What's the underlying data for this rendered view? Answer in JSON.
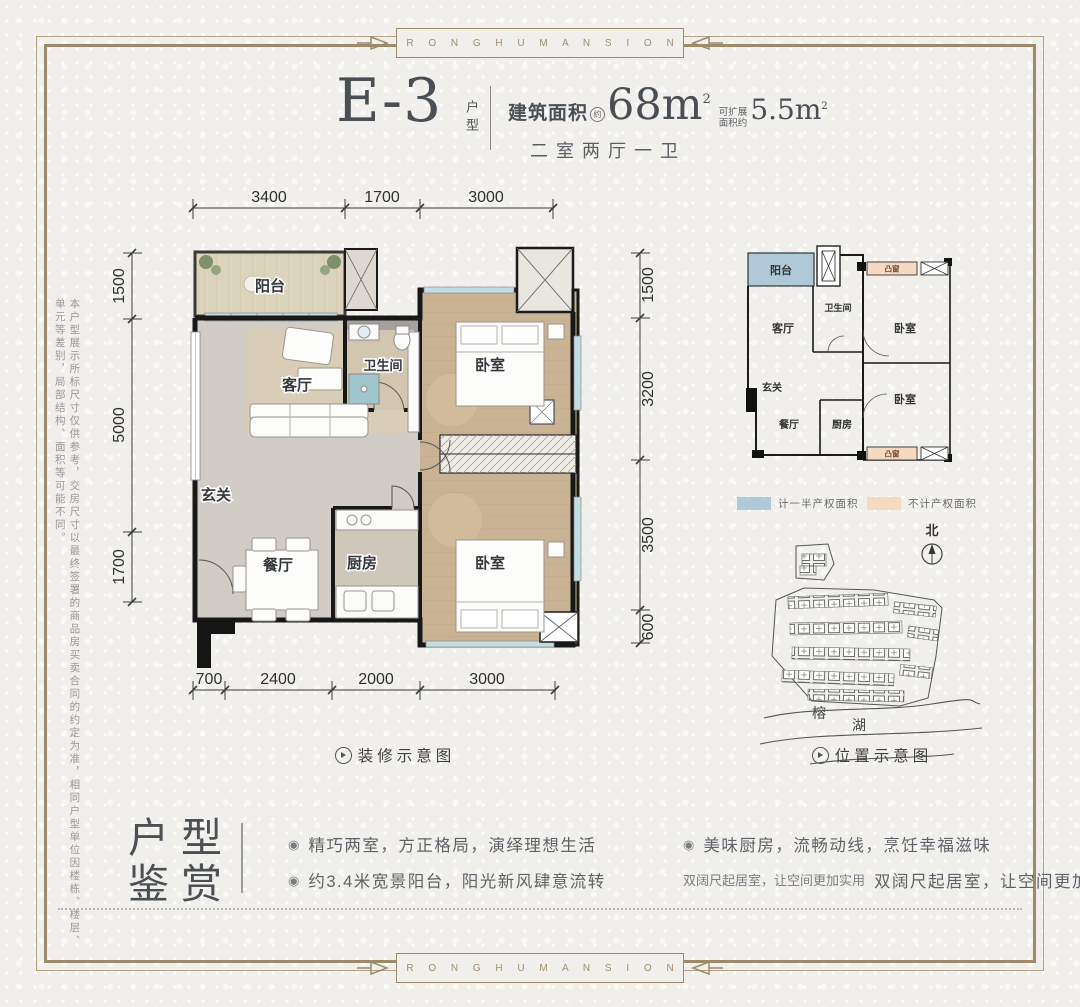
{
  "border": {
    "brand_text": "R O N G H U M A N S I O N"
  },
  "header": {
    "unit_code": "E-3",
    "unit_type_vertical": "户型",
    "area_label": "建筑面积",
    "area_approx_badge": "约",
    "area_value": "68m",
    "area_sup": "2",
    "expand_label_line1": "可扩展",
    "expand_label_line2": "面积约",
    "expand_value": "5.5m",
    "expand_sup": "2",
    "rooms_summary": "二室两厅一卫"
  },
  "side_note": "本户型展示所标尺寸仅供参考，交房尺寸以最终签署的商品房买卖合同的约定为准，相同户型单位因楼栋、楼层、单元等差别，局部结构、面积等可能不同。",
  "floorplan": {
    "caption": "装修示意图",
    "dims_top": [
      "3400",
      "1700",
      "3000"
    ],
    "dims_left": [
      "1500",
      "5000",
      "1700"
    ],
    "dims_right": [
      "1500",
      "3200",
      "3500",
      "600"
    ],
    "dims_bottom": [
      "700",
      "2400",
      "2000",
      "3000"
    ],
    "rooms": {
      "balcony": "阳台",
      "living": "客厅",
      "bathroom": "卫生间",
      "bedroom_top": "卧室",
      "foyer": "玄关",
      "dining": "餐厅",
      "kitchen": "厨房",
      "bedroom_bottom": "卧室"
    }
  },
  "keyplan": {
    "rooms": {
      "balcony": "阳台",
      "living": "客厅",
      "bathroom": "卫生间",
      "bedroom_top": "卧室",
      "foyer": "玄关",
      "dining": "餐厅",
      "kitchen": "厨房",
      "bedroom_bottom": "卧室"
    },
    "bay_window_top": "凸窗",
    "bay_window_bottom": "凸窗",
    "legend": [
      {
        "label": "计一半产权面积",
        "color": "#afc9d9"
      },
      {
        "label": "不计产权面积",
        "color": "#f6d9c1"
      }
    ],
    "north_label": "北"
  },
  "siteplan": {
    "caption": "位置示意图",
    "lake_char1": "榕",
    "lake_char2": "湖"
  },
  "appreciation": {
    "title_line1": "户型",
    "title_line2": "鉴赏",
    "bullet_icon": "◉",
    "bullets_left": [
      "精巧两室，方正格局，演绎理想生活",
      "约3.4米宽景阳台，阳光新风肆意流转"
    ],
    "bullets_right": [
      "美味厨房，流畅动线，烹饪幸福滋味",
      "双阔尺起居室，让空间更加实用"
    ]
  }
}
